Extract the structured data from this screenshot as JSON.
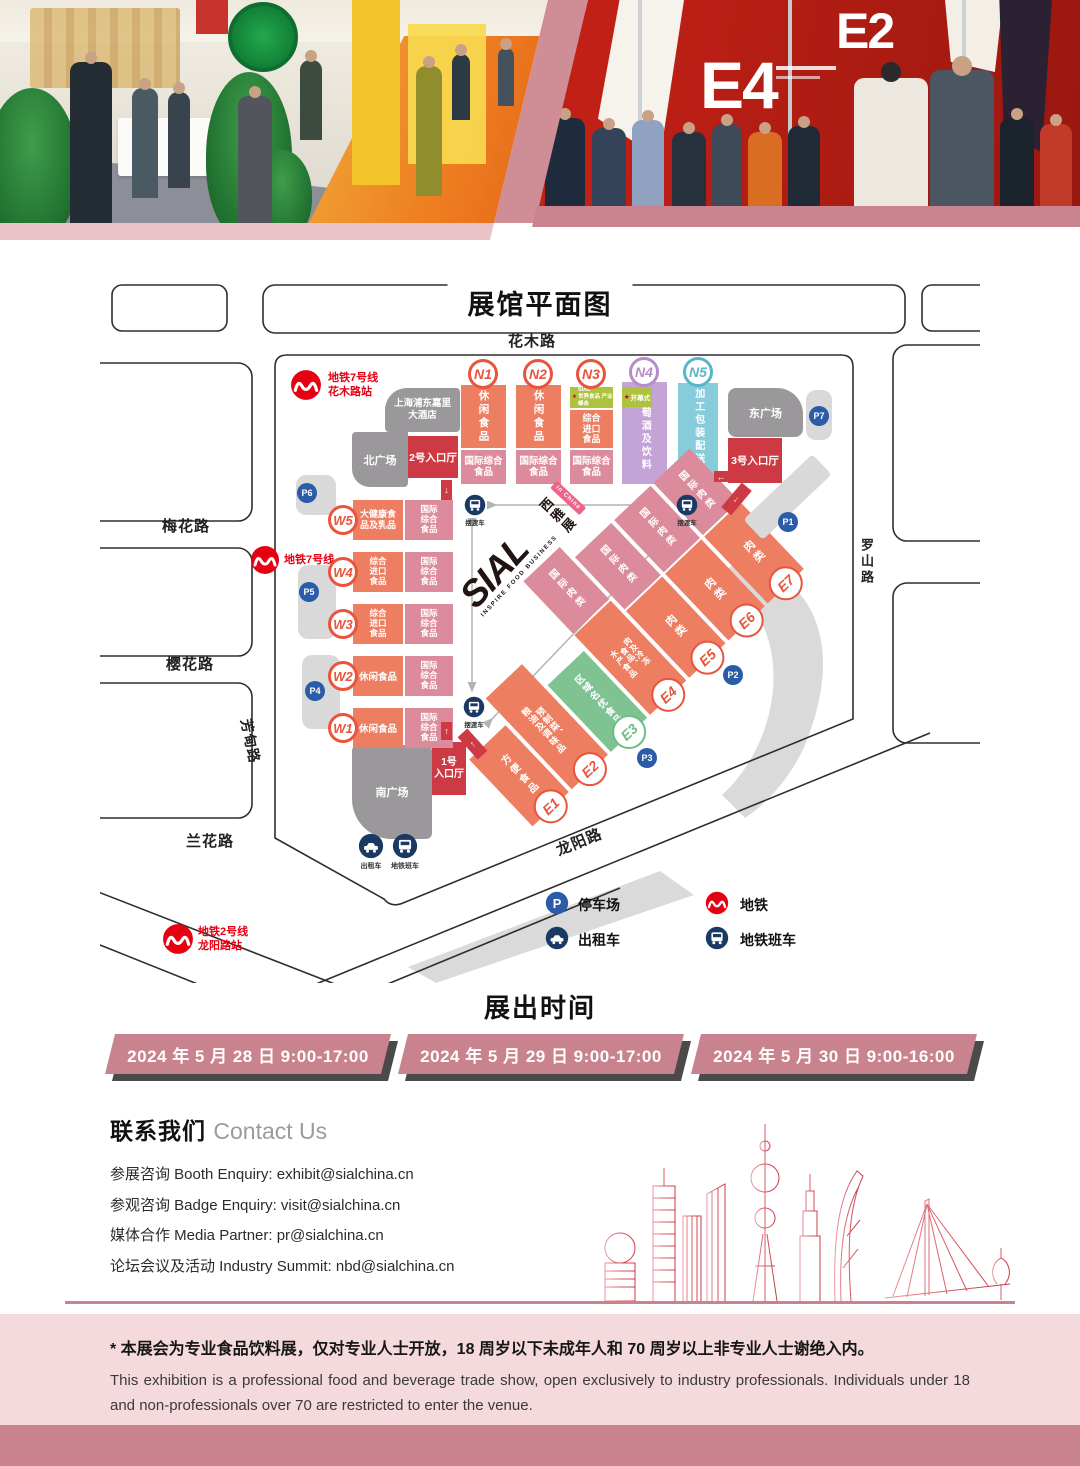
{
  "header": {
    "banner_e4": "E4",
    "banner_e2": "E2"
  },
  "map": {
    "title": "展馆平面图",
    "roads": {
      "top": "花木路",
      "left_1": "梅花路",
      "left_2": "樱花路",
      "left_3": "兰花路",
      "left_vertical": "芳甸路",
      "right_vertical": "罗山路",
      "bottom": "龙阳路"
    },
    "metro_badges": {
      "line7_station": "地铁7号线\n花木路站",
      "line7": "地铁7号线",
      "line2_station": "地铁2号线\n龙阳路站"
    },
    "buildings": {
      "hotel": "上海浦东嘉里\n大酒店",
      "north_plaza": "北广场",
      "east_plaza": "东广场",
      "south_plaza": "南广场"
    },
    "entrances": {
      "hall1": "1号\n入口厅",
      "hall2": "2号入口厅",
      "hall3": "3号入口厅"
    },
    "star": "★",
    "n_halls": [
      {
        "id": "N1",
        "main": "休闲食品",
        "sub": "国际综合\n食品"
      },
      {
        "id": "N2",
        "main": "休闲食品",
        "sub": "国际综合\n食品"
      },
      {
        "id": "N3",
        "tag": "SIAL\n世界食品 产业峰会",
        "main": "综合\n进口\n食品",
        "sub": "国际综合\n食品"
      },
      {
        "id": "N4",
        "tag": "开幕式",
        "main": "葡萄酒及饮料"
      },
      {
        "id": "N5",
        "main": "加工包装配送展"
      }
    ],
    "w_halls": [
      {
        "id": "W5",
        "main": "大健康食\n品及乳品",
        "sub": "国际\n综合\n食品"
      },
      {
        "id": "W4",
        "main": "综合\n进口\n食品",
        "sub": "国际\n综合\n食品"
      },
      {
        "id": "W3",
        "main": "综合\n进口\n食品",
        "sub": "国际\n综合\n食品"
      },
      {
        "id": "W2",
        "main": "休闲食品",
        "sub": "国际\n综合\n食品"
      },
      {
        "id": "W1",
        "main": "休闲食品",
        "sub": "国际\n综合\n食品"
      }
    ],
    "e_halls": [
      {
        "id": "E1",
        "main": "方便食品"
      },
      {
        "id": "E2",
        "main": "预制菜、\n粮油及调味品"
      },
      {
        "id": "E3",
        "main": "区域名优食品"
      },
      {
        "id": "E4",
        "pink": "国际肉类",
        "main": "肉及冷冻\n食品、\n水产食品"
      },
      {
        "id": "E5",
        "pink": "国际肉类",
        "main": "肉类"
      },
      {
        "id": "E6",
        "pink": "国际肉类",
        "main": "肉类"
      },
      {
        "id": "E7",
        "pink": "国际肉类",
        "main": "肉类"
      }
    ],
    "parking": [
      "P1",
      "P2",
      "P3",
      "P4",
      "P5",
      "P6",
      "P7"
    ],
    "shuttle_label": "摆渡车",
    "station_icons": {
      "taxi": "出租车",
      "shuttle": "地铁班车"
    },
    "legend": [
      {
        "icon": "parking-icon",
        "label": "停车场"
      },
      {
        "icon": "taxi-icon",
        "label": "出租车"
      },
      {
        "icon": "metro-icon",
        "label": "地铁"
      },
      {
        "icon": "bus-icon",
        "label": "地铁班车"
      }
    ],
    "logo": {
      "name": "SIAL",
      "tagline": "INSPIRE FOOD BUSINESS",
      "cn": "西雅展",
      "badge": "in China"
    }
  },
  "schedule": {
    "title": "展出时间",
    "dates": [
      "2024 年 5 月 28 日  9:00-17:00",
      "2024 年 5 月 29 日  9:00-17:00",
      "2024 年 5 月 30 日  9:00-16:00"
    ]
  },
  "contact": {
    "title_cn": "联系我们 ",
    "title_en": "Contact Us",
    "lines": [
      "参展咨询 Booth Enquiry: exhibit@sialchina.cn",
      "参观咨询 Badge Enquiry: visit@sialchina.cn",
      "媒体合作 Media Partner: pr@sialchina.cn",
      "论坛会议及活动 Industry Summit: nbd@sialchina.cn"
    ]
  },
  "disclaimer": {
    "cn": "* 本展会为专业食品饮料展，仅对专业人士开放，18 周岁以下未成年人和 70 周岁以上非专业人士谢绝入内。",
    "en": "This exhibition is a professional food and beverage trade show, open exclusively to industry professionals. Individuals under 18 and non-professionals over 70 are restricted to enter the venue."
  }
}
